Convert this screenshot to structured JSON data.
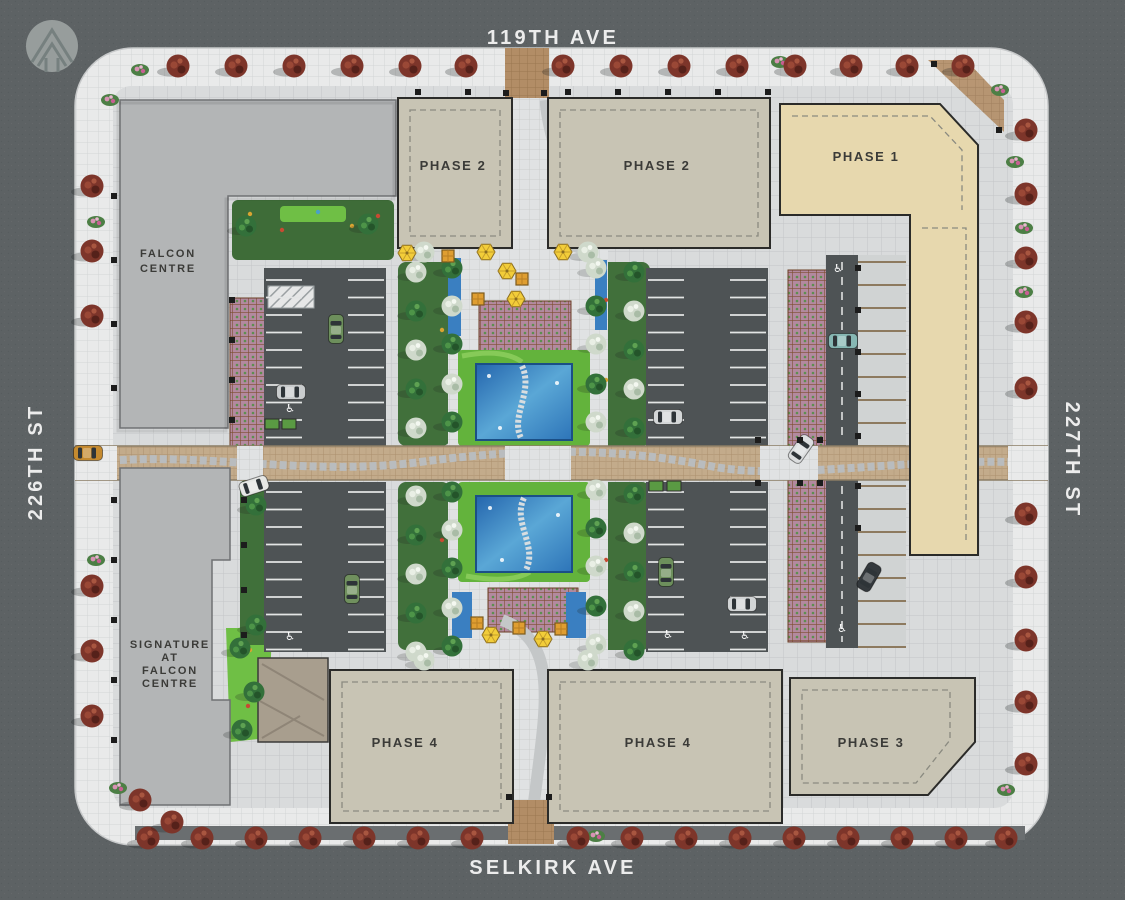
{
  "map": {
    "type": "architectural-site-plan",
    "streets": {
      "top": "119TH AVE",
      "bottom": "SELKIRK AVE",
      "left": "226TH ST",
      "right": "227TH ST"
    },
    "buildings": {
      "falcon_centre": {
        "label": "FALCON CENTRE",
        "lines": [
          "FALCON",
          "CENTRE"
        ],
        "color": "#b3b5b6"
      },
      "signature": {
        "label": "SIGNATURE AT FALCON CENTRE",
        "lines": [
          "SIGNATURE",
          "AT",
          "FALCON",
          "CENTRE"
        ],
        "color": "#b3b5b6"
      },
      "phase1": {
        "label": "PHASE 1",
        "color": "#e7d8ae"
      },
      "phase2_west": {
        "label": "PHASE 2",
        "color": "#c8c4b4"
      },
      "phase2_east": {
        "label": "PHASE 2",
        "color": "#c8c4b4"
      },
      "phase3": {
        "label": "PHASE 3",
        "color": "#c8c4b4"
      },
      "phase4_west": {
        "label": "PHASE 4",
        "color": "#c8c4b4"
      },
      "phase4_east": {
        "label": "PHASE 4",
        "color": "#c8c4b4"
      }
    },
    "icons": {
      "accessible_parking_glyph": "♿",
      "north_logo": "stylized-arrow-in-circle"
    },
    "colors": {
      "street_asphalt": "#5d6264",
      "sidewalk": "#e9eaea",
      "plaza_paving": "#e0e2e3",
      "parking_asphalt": "#4e5355",
      "road_pavers": "#c3ab8b",
      "pool_water": "#2d74b8",
      "lawn": "#63b33c",
      "street_tree": "#7d352a",
      "green_tree": "#33703a",
      "silver_tree": "#cfd9cb",
      "umbrella": "#f2cd39",
      "label_text": "#3b3b38",
      "street_text": "#ececec"
    }
  }
}
